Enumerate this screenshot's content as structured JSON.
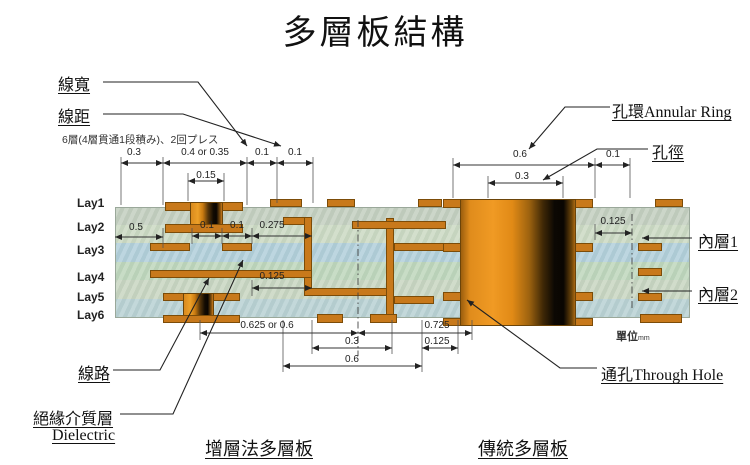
{
  "title": "多層板結構",
  "note": "6層(4層貫通1段積み)、2回プレス",
  "labels": {
    "line_width": "線寬",
    "line_spacing": "線距",
    "trace": "線路",
    "dielectric_zh": "絕緣介質層",
    "dielectric_en": "Dielectric",
    "annular_ring": "孔環Annular Ring",
    "hole_diameter": "孔徑",
    "inner_layer_1": "內層1",
    "inner_layer_2": "內層2",
    "through_hole": "通孔Through Hole",
    "unit_zh": "單位",
    "unit_en": "mm",
    "buildup_board": "增層法多層板",
    "traditional_board": "傳統多層板"
  },
  "layers": [
    "Lay1",
    "Lay2",
    "Lay3",
    "Lay4",
    "Lay5",
    "Lay6"
  ],
  "dims": {
    "tl_03": "0.3",
    "tl_04": "0.4 or 0.35",
    "tl_01a": "0.1",
    "tl_01b": "0.1",
    "tl_015": "0.15",
    "tr_06": "0.6",
    "tr_01": "0.1",
    "tr_03": "0.3",
    "m_05": "0.5",
    "m_01a": "0.1",
    "m_01b": "0.1",
    "m_0275": "0.275",
    "m_0125": "0.125",
    "r_0125": "0.125",
    "b_0625": "0.625 or 0.6",
    "b_0725": "0.725",
    "b_03": "0.3",
    "b_0125": "0.125",
    "b_06": "0.6"
  },
  "colors": {
    "copper": "#c8791b",
    "hole_dark": "#0a0602",
    "dielectric_green": "#ccdac4",
    "dielectric_blue": "#b2cfdb"
  }
}
